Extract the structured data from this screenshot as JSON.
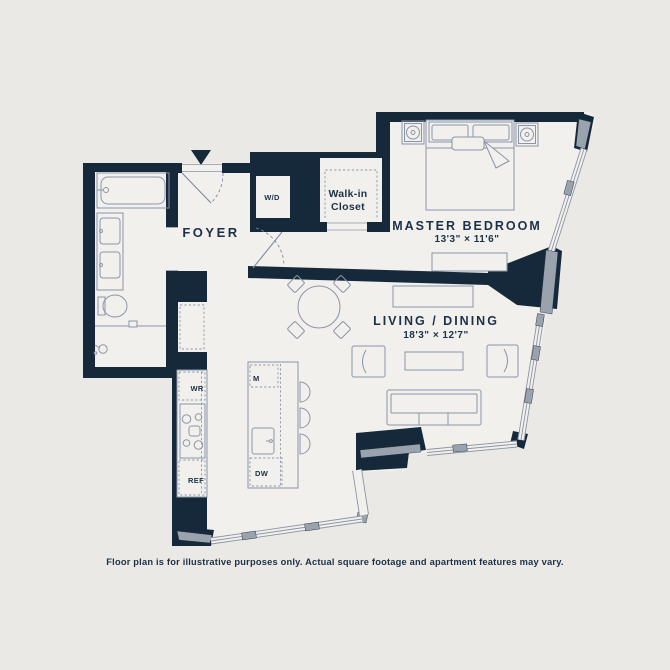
{
  "floor_plan": {
    "labels": {
      "foyer": "FOYER",
      "wd": "W/D",
      "walk_in_1": "Walk-in",
      "walk_in_2": "Closet",
      "master_bedroom": "MASTER BEDROOM",
      "master_bedroom_dim": "13'3\" × 11'6\"",
      "living_dining": "LIVING / DINING",
      "living_dining_dim": "18'3\" × 12'7\"",
      "wine_ref": "WR",
      "microwave": "M",
      "dishwasher": "DW",
      "refrigerator": "REF"
    },
    "disclaimer": "Floor plan is for illustrative purposes only. Actual square footage and apartment features may vary.",
    "colors": {
      "background": "#ebe9e6",
      "interior": "#f2f0ed",
      "wall": "#16293a",
      "line": "#8b95a6",
      "window_gray": "#9aa3ad",
      "text": "#1b3147"
    }
  }
}
